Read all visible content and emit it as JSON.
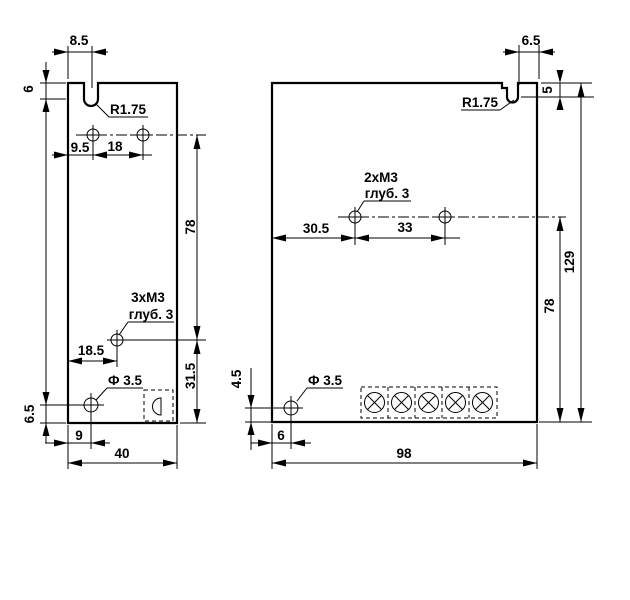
{
  "drawing": {
    "left_view": {
      "slot_width": "8.5",
      "slot_depth": "6",
      "slot_radius": "R1.75",
      "hole_offset": "9.5",
      "hole_spacing": "18",
      "row_spacing": "78",
      "thread_callout_line1": "3xM3",
      "thread_callout_line2": "глуб. 3",
      "thread_offset": "18.5",
      "thread_to_bottom": "31.5",
      "hole_diameter": "Ф 3.5",
      "bottom_hole_height": "6.5",
      "bottom_hole_offset": "9",
      "width": "40"
    },
    "right_view": {
      "slot_width": "6.5",
      "slot_depth": "5",
      "slot_radius": "R1.75",
      "thread_callout_line1": "2xM3",
      "thread_callout_line2": "глуб. 3",
      "thread_offset": "30.5",
      "thread_spacing": "33",
      "height": "129",
      "row_to_bottom": "78",
      "hole_diameter": "Ф 3.5",
      "bottom_hole_height": "4.5",
      "bottom_hole_offset": "6",
      "width": "98"
    }
  }
}
